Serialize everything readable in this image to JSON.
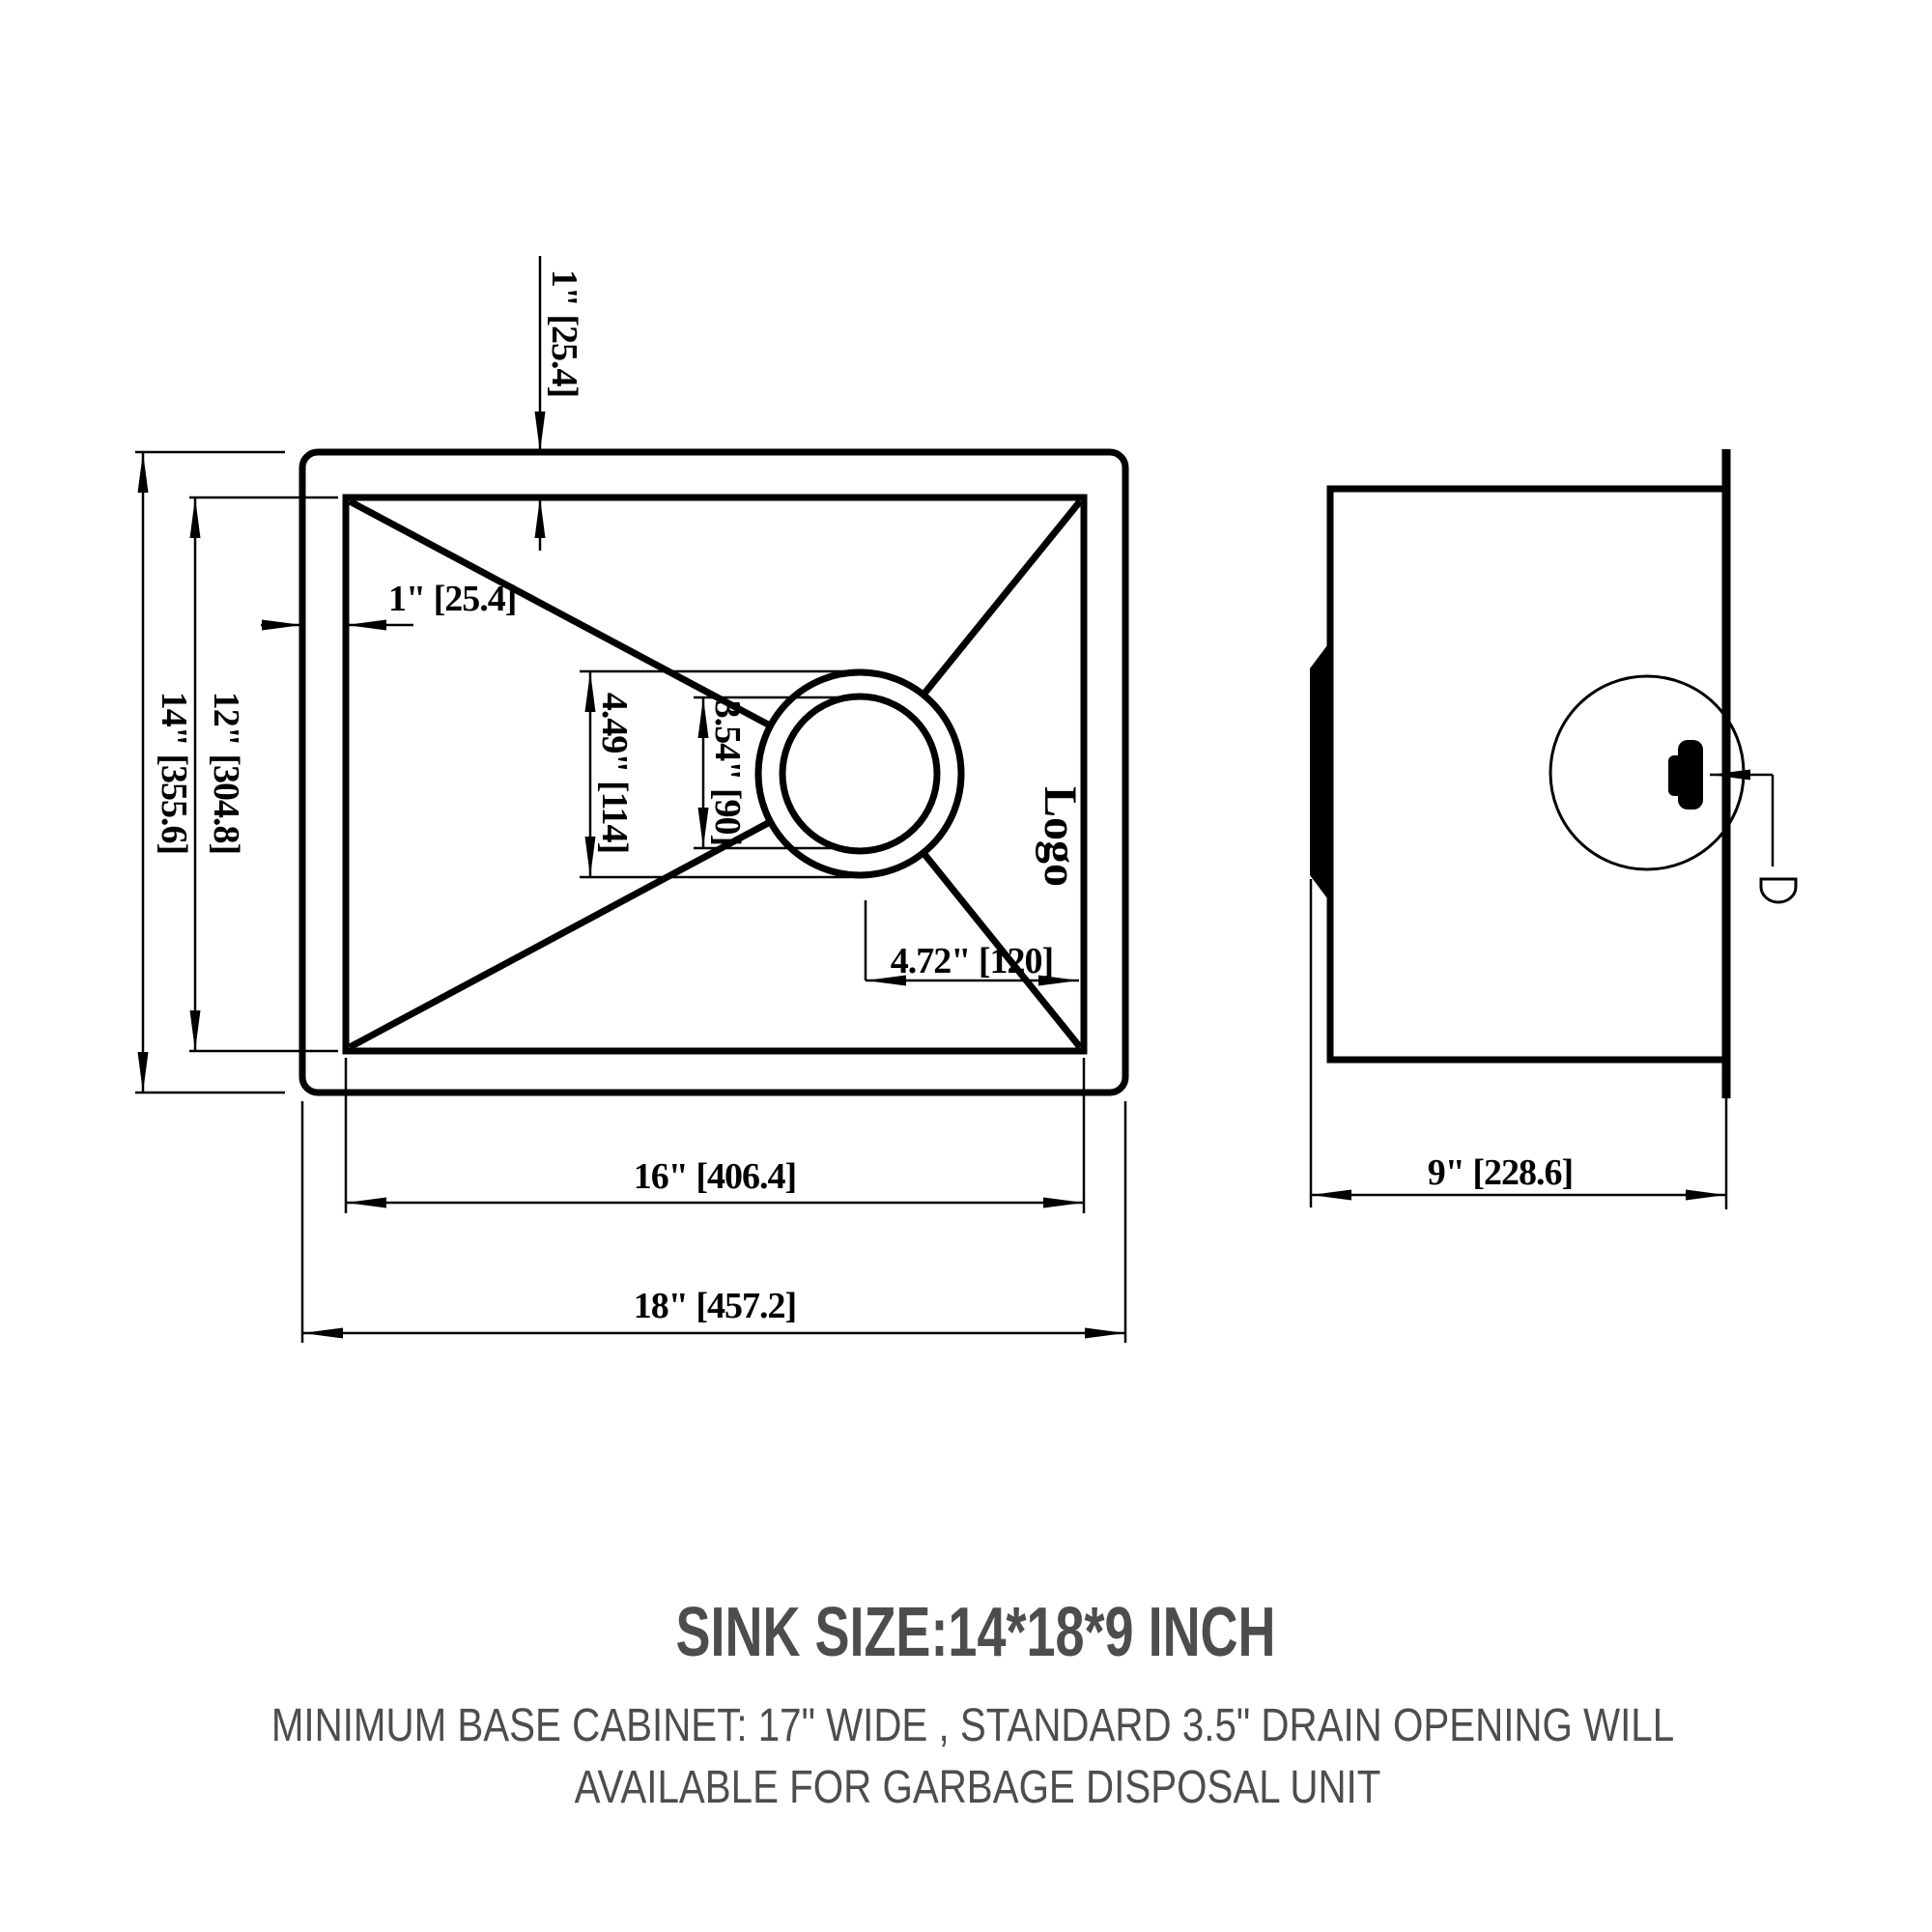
{
  "title_block": {
    "sink_size": "SINK SIZE:14*18*9 INCH",
    "note_line1": "MINIMUM BASE CABINET: 17\" WIDE , STANDARD 3.5\" DRAIN OPENING WILL",
    "note_line2": "AVAILABLE FOR GARBAGE DISPOSAL UNIT"
  },
  "top_view": {
    "logo": "Logo",
    "dims": {
      "rim_top": "1\" [25.4]",
      "rim_left": "1\" [25.4]",
      "outer_height": "14\" [355.6]",
      "inner_height": "12\" [304.8]",
      "drain_outer_dia": "4.49\" [114]",
      "drain_inner_dia": "3.54\" [90]",
      "drain_offset": "4.72\" [120]",
      "inner_width": "16\" [406.4]",
      "outer_width": "18\" [457.2]"
    }
  },
  "side_view": {
    "depth": "9\" [228.6]"
  },
  "colors": {
    "line": "#000000",
    "note_text": "#4d4d4d",
    "background": "#ffffff"
  }
}
